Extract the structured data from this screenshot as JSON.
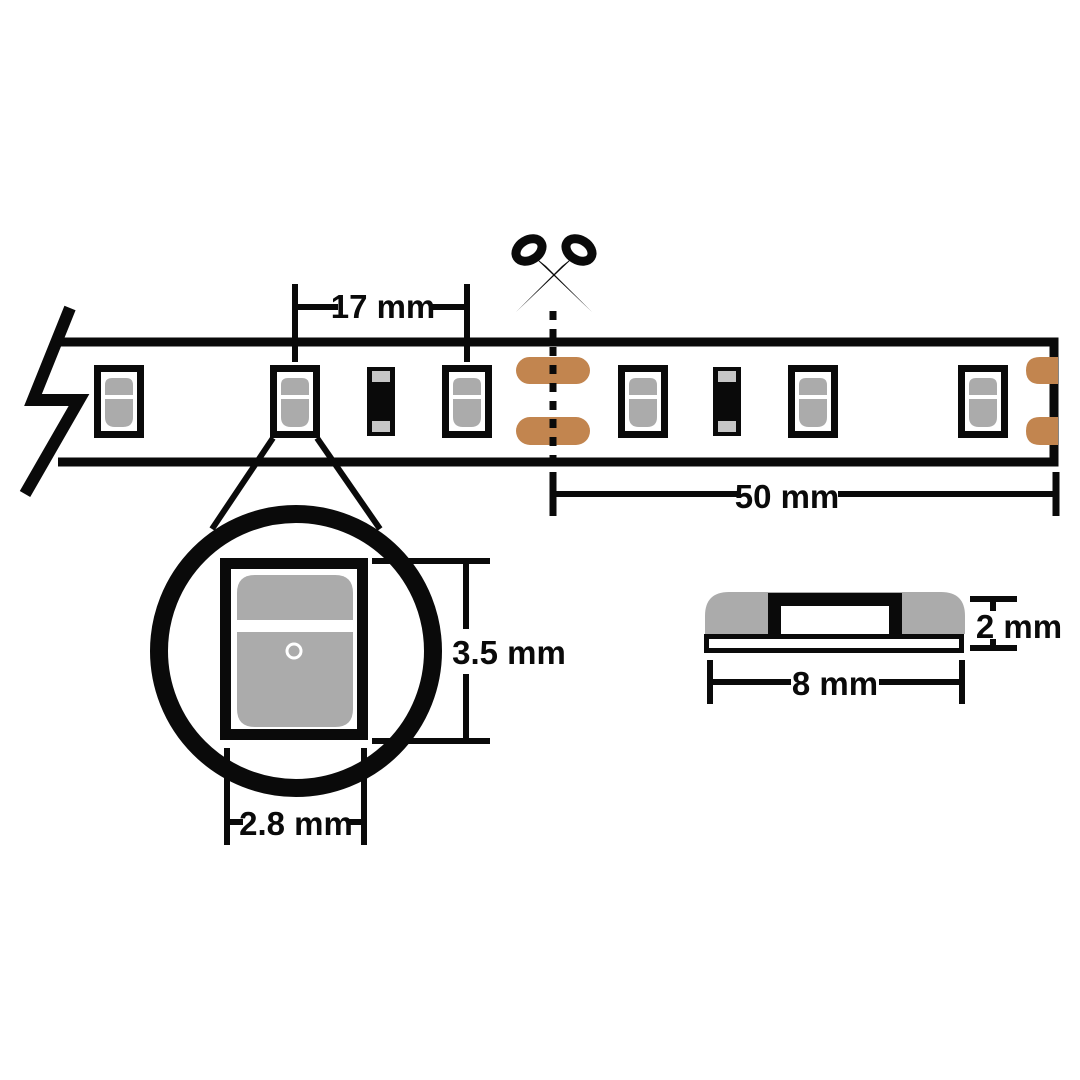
{
  "labels": {
    "led_pitch": "17 mm",
    "cut_length": "50 mm",
    "led_height": "3.5 mm",
    "led_width": "2.8 mm",
    "strip_thickness": "2 mm",
    "strip_width": "8 mm"
  },
  "colors": {
    "line": "#0a0a0a",
    "copper_pad": "#c2854f",
    "component_gray": "#ababab",
    "resistor_cap_gray": "#c6c6c6",
    "background": "#ffffff"
  },
  "icons": {
    "scissors": "scissors-icon",
    "strip_break": "break-symbol-icon",
    "magnifier": "magnifier-circle-icon"
  }
}
